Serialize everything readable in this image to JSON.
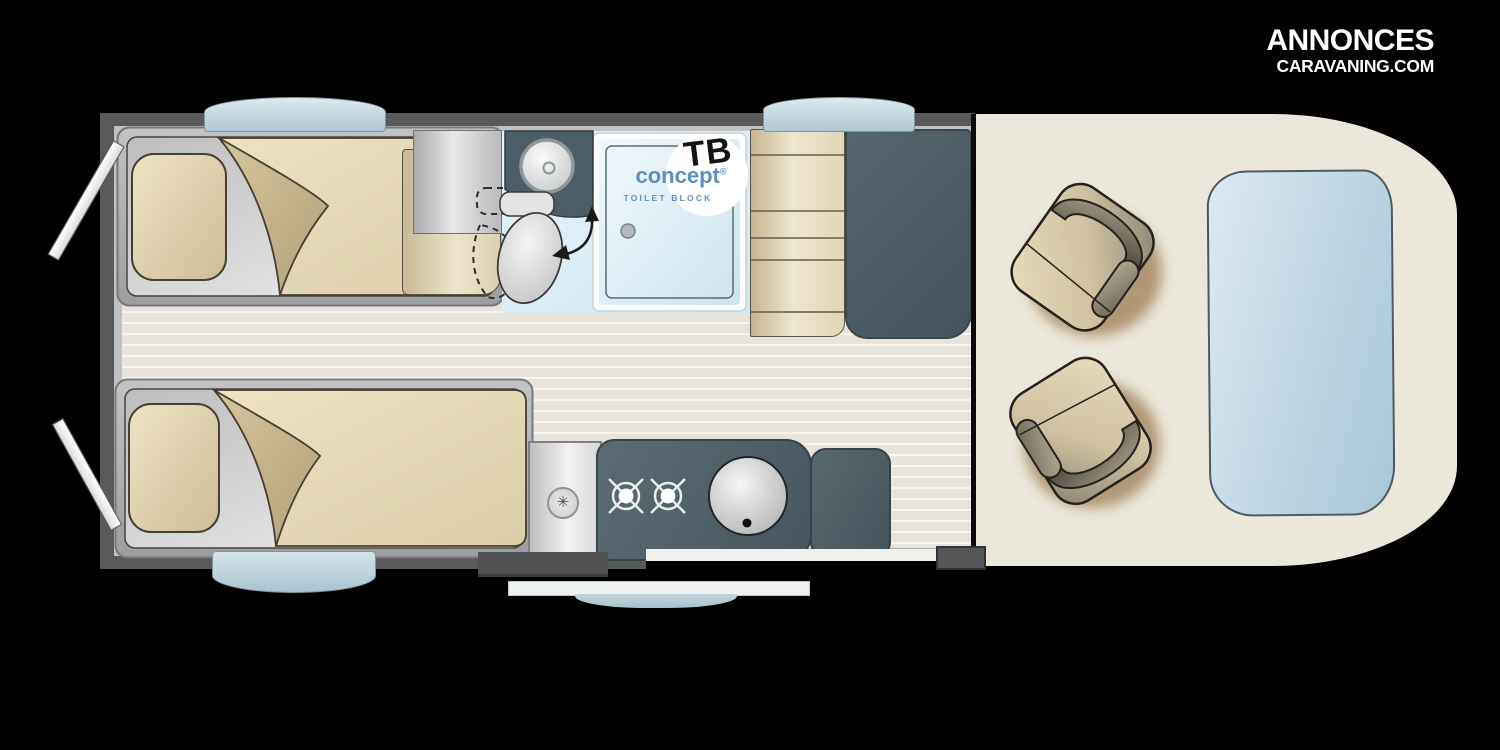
{
  "branding": {
    "line1": "ANNONCES",
    "line2": "CARAVANING.COM"
  },
  "bathroom_logo": {
    "abbr": "TB",
    "name": "concept",
    "registered": "®",
    "subtitle": "TOILET BLOCK"
  },
  "icons": {
    "heater_vent": "✳"
  },
  "colors": {
    "background": "#000000",
    "wall_gray": "#58595b",
    "floor_stripe": "#e8e4db",
    "cab_floor_cream": "#ebe7da",
    "cabinet_slate": "#4d5f66",
    "bedding_beige": "#e8dcbc",
    "drawer_tan": "#d9cbaa",
    "bathroom_floor_blue": "#ddeef6",
    "glass_blue": "#aec9d5",
    "logo_blue": "#5f8fbe",
    "logo_white": "#ffffff"
  }
}
